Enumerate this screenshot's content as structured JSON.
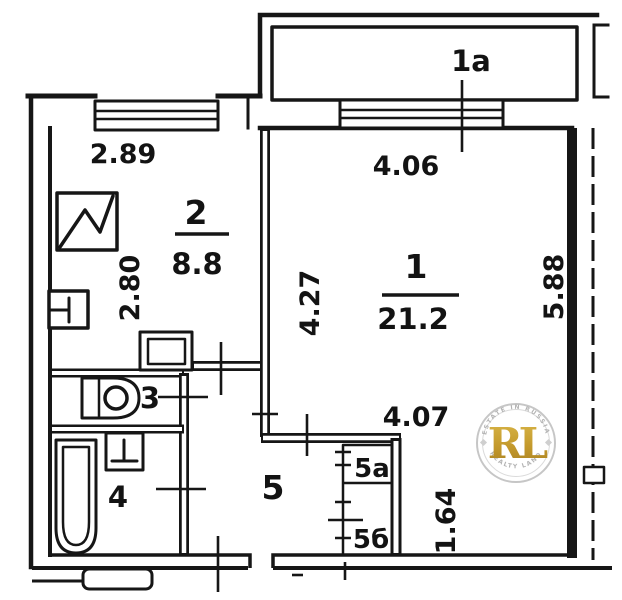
{
  "rooms": {
    "balcony": {
      "number": "1a"
    },
    "room1": {
      "number": "1",
      "area": "21.2"
    },
    "kitchen": {
      "number": "2",
      "area": "8.8"
    },
    "toilet": {
      "number": "3"
    },
    "bathroom": {
      "number": "4"
    },
    "hallway": {
      "number": "5"
    },
    "closet_a": {
      "number": "5а"
    },
    "closet_b": {
      "number": "5б"
    }
  },
  "dimensions": {
    "kitchen_width": "2.89",
    "kitchen_depth": "2.80",
    "room1_width_top": "4.06",
    "room1_height_left": "4.27",
    "room1_height_right": "5.88",
    "room1_width_bottom": "4.07",
    "room1_lower_height": "1.64"
  },
  "watermark": {
    "initials": "RL",
    "arc_top": "ESTATE IN RUSSIA",
    "arc_bottom": "REALTY LAND"
  },
  "colors": {
    "ink": "#161616",
    "gold": "#c8a02e",
    "watermark_gray": "#b3b3b3"
  }
}
